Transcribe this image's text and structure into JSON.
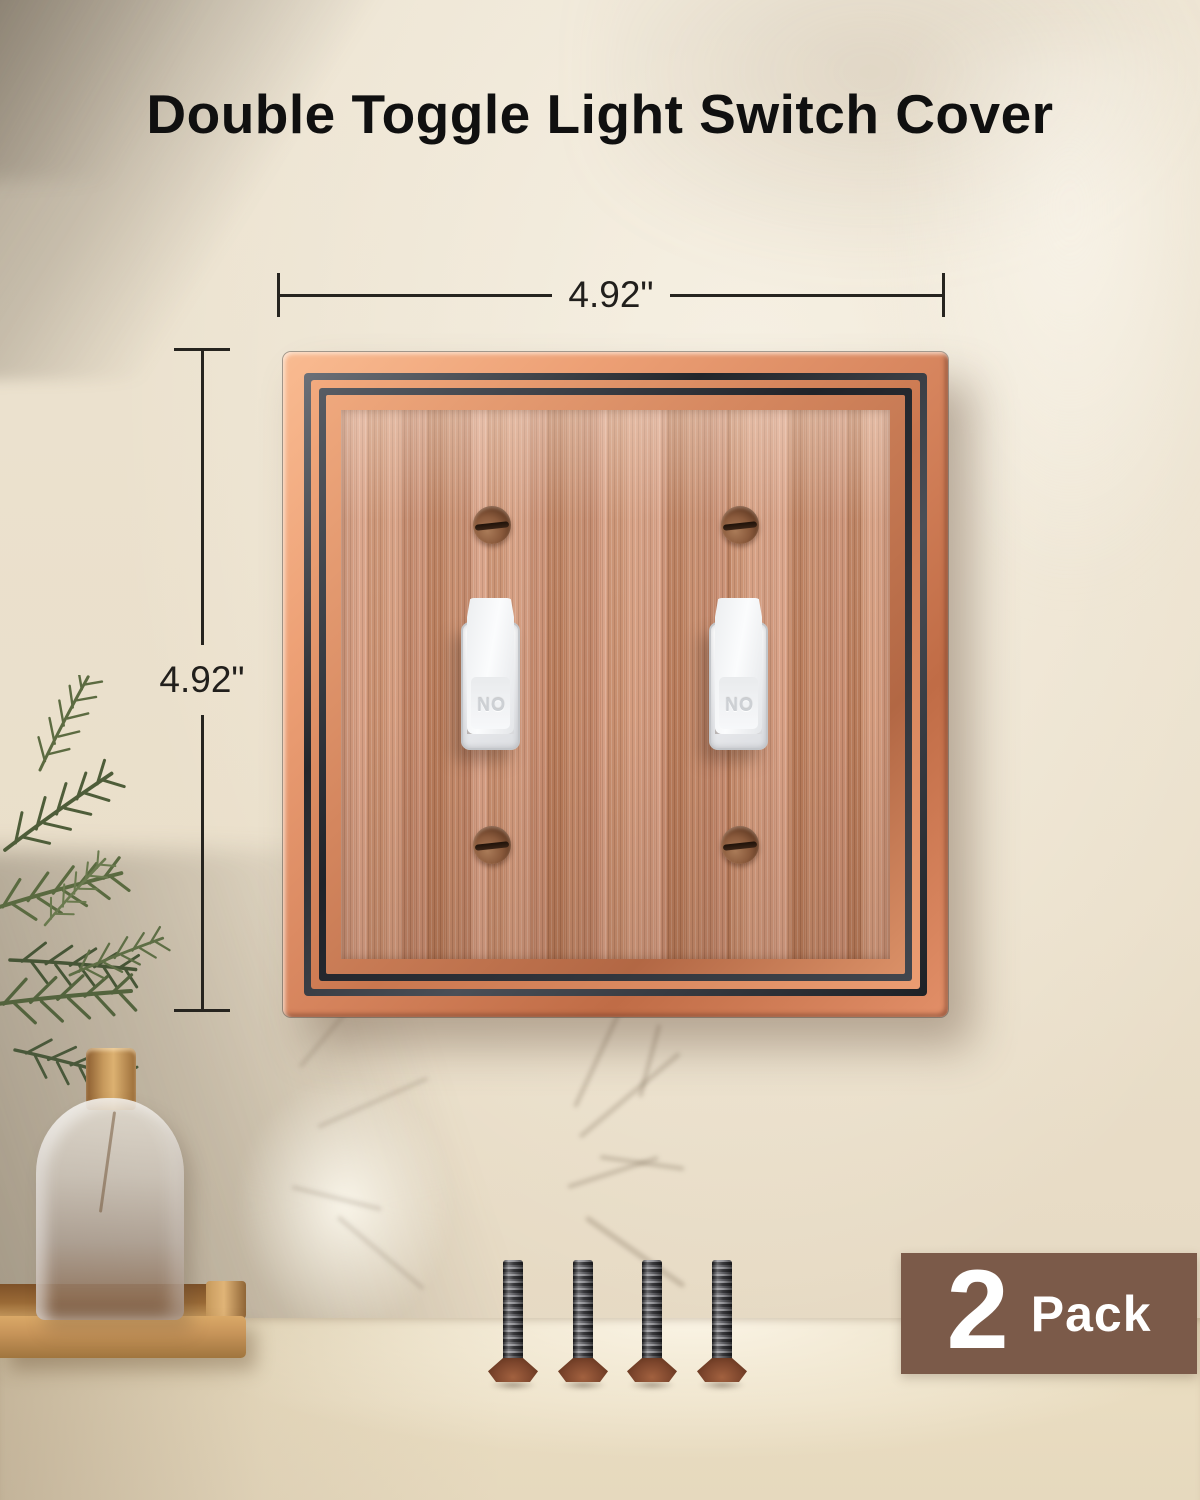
{
  "title": "Double Toggle Light Switch Cover",
  "dimensions": {
    "width_label": "4.92\"",
    "height_label": "4.92\""
  },
  "plate": {
    "toggles": [
      {
        "label": "ON"
      },
      {
        "label": "ON"
      }
    ],
    "mounting_screw_count": 4
  },
  "included_screw_count": 4,
  "badge": {
    "count": "2",
    "label": "Pack"
  },
  "colors": {
    "copper_field": "#c98b6c",
    "copper_frame_highlight": "#f3aa7e",
    "frame_dark": "#2b2e34",
    "badge_brown": "#7b5a49",
    "badge_text": "#ffffff",
    "wall_cream": "#ece3d1",
    "counter_beige": "#e6d9be",
    "title_black": "#101010",
    "dimension_line": "#26241f",
    "toggle_white": "#f2f3f5",
    "screw_bronze": "#7c452c"
  }
}
